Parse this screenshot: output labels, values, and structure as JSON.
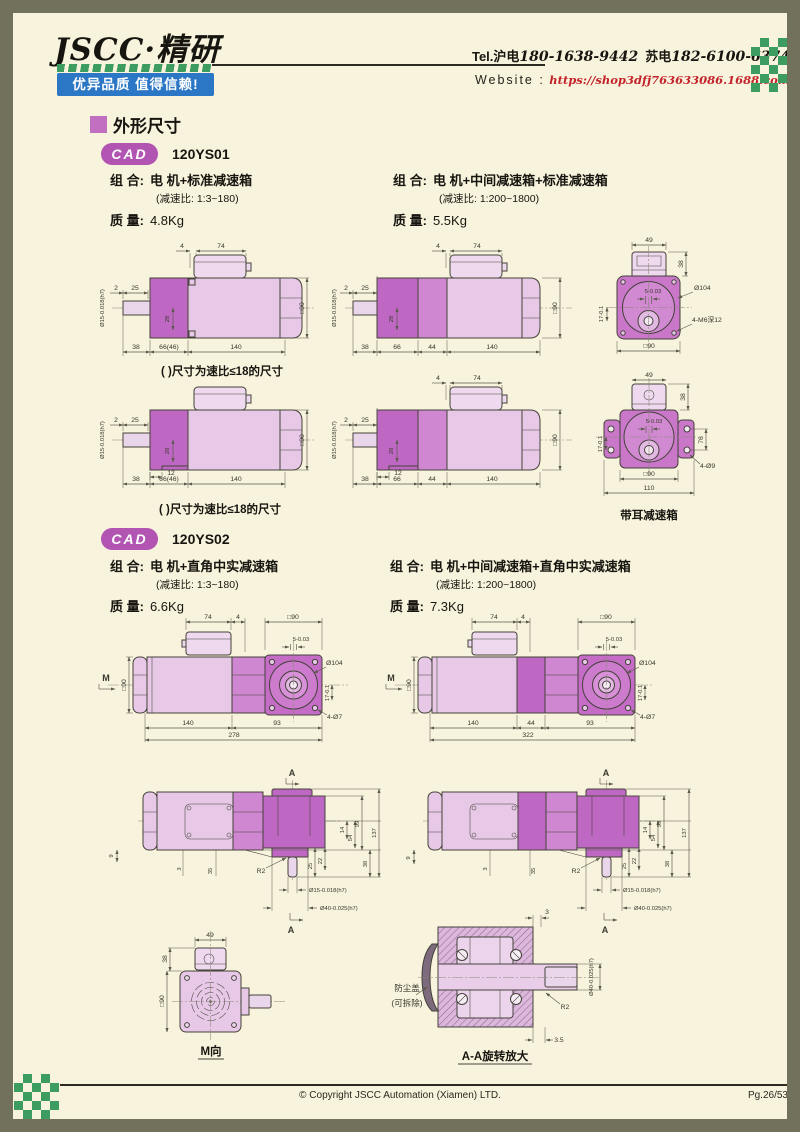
{
  "page": {
    "bg": "#f8f3dd",
    "frame": "#72725c"
  },
  "header": {
    "logo": "JSCC·精研",
    "slogan": "优异品质 值得信赖!",
    "tel_prefix": "Tel.",
    "tel_a_label": "沪电",
    "tel_a": "180-1638-9442",
    "tel_b_label": "苏电",
    "tel_b": "182-6100-6374",
    "website_label": "Website :",
    "website_url": "https://shop3dfj763633086.1688.com"
  },
  "section": {
    "title": "外形尺寸"
  },
  "cad_badge": "CAD",
  "ys01": {
    "model": "120YS01",
    "combo_label": "组 合:",
    "mass_label": "质 量:",
    "left": {
      "combo": "电 机+标准减速箱",
      "ratio": "(减速比: 1:3~180)",
      "mass": "4.8Kg"
    },
    "right": {
      "combo": "电 机+中间减速箱+标准减速箱",
      "ratio": "(减速比: 1:200~1800)",
      "mass": "5.5Kg"
    },
    "note": "( )尺寸为速比≤18的尺寸",
    "ear_caption": "带耳减速箱"
  },
  "ys02": {
    "model": "120YS02",
    "left": {
      "combo": "电 机+直角中实减速箱",
      "ratio": "(减速比: 1:3~180)",
      "mass": "6.6Kg"
    },
    "right": {
      "combo": "电 机+中间减速箱+直角中实减速箱",
      "ratio": "(减速比: 1:200~1800)",
      "mass": "7.3Kg"
    },
    "m_caption": "M向",
    "aa_caption": "A-A旋转放大",
    "dust_cover_1": "防尘盖",
    "dust_cover_2": "(可拆除)"
  },
  "dims": {
    "d2": "2",
    "d3": "3",
    "d3_5": "3.5",
    "d4": "4",
    "d5": "5-0.03",
    "d9": "9",
    "d12": "12",
    "d14": "14",
    "d17": "17-0.1",
    "d22": "22",
    "d25": "25",
    "d28": "28",
    "d35": "35",
    "d38": "38",
    "d44": "44",
    "d49": "49",
    "d54": "54",
    "d66": "66",
    "d66_46": "66(46)",
    "d74": "74",
    "d76": "76",
    "d93": "93",
    "d99": "99",
    "d104": "Ø104",
    "d110": "110",
    "d137": "137",
    "d140": "140",
    "d278": "278",
    "d322": "322",
    "sq90": "□90",
    "d15h7": "Ø15-0.018(h7)",
    "d40h7": "Ø40-0.025(h7)",
    "tap": "4-M6深12",
    "h9": "4-Ø9",
    "h7": "4-Ø7",
    "r2": "R2",
    "secA": "A",
    "viewM": "M"
  },
  "footer": {
    "copyright": "© Copyright JSCC Automation (Xiamen) LTD.",
    "page": "Pg.26/53"
  }
}
